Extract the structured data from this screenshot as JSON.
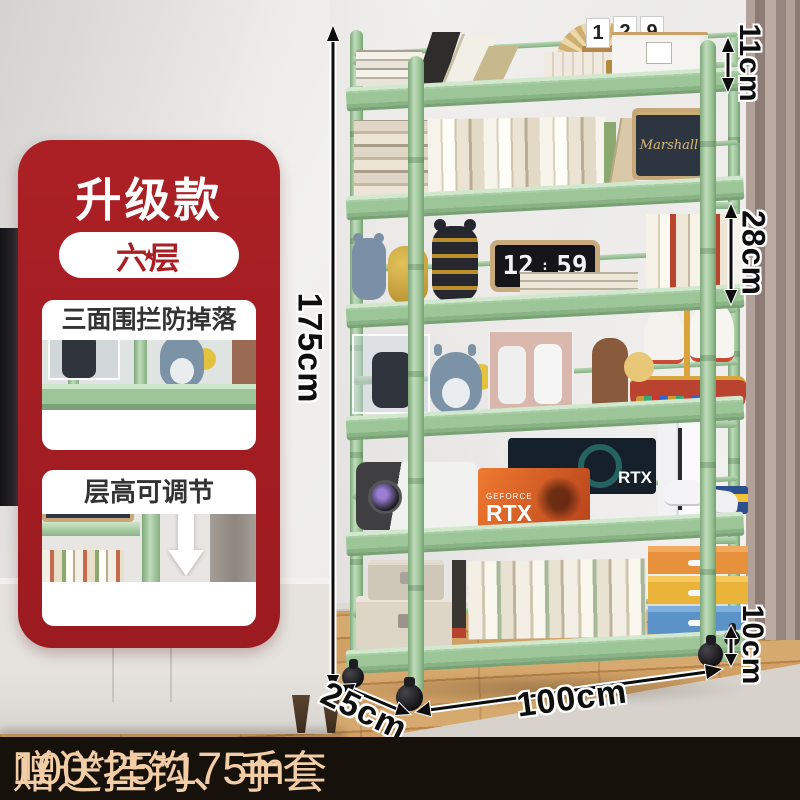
{
  "product_badge": {
    "title": "升级款",
    "tier_pill": {
      "left_star": "★",
      "label": "六层",
      "right_star": "★"
    },
    "features": [
      {
        "caption": "三面围拦防掉落"
      },
      {
        "caption": "层高可调节"
      }
    ]
  },
  "dimensions": {
    "total_height": "175cm",
    "top_guard_height": "11cm",
    "tier_spacing": "28cm",
    "wheel_clearance": "10cm",
    "width": "100cm",
    "depth": "25cm"
  },
  "shelf_decor": {
    "calendar_digits": [
      "1",
      "2",
      "9"
    ],
    "flip_clock_hour": "12",
    "flip_clock_minute": "59",
    "speaker_brand": "Marshall",
    "gpu_box_front_brand": "GEFORCE",
    "gpu_box_front_model": "RTX",
    "gpu_box_back_model": "RTX"
  },
  "footer": {
    "size_text": "100*25*175m",
    "divider": "/",
    "gift_text": "赠送挂钩、手套"
  },
  "colors": {
    "shelf_green": "#9cc598",
    "badge_red": "#a81f24",
    "footer_background": "#17110c",
    "footer_text": "#f3cda6",
    "dimension_text": "#0e0e0e",
    "curtain": "#a3918a",
    "wood_floor": "#c79a5f"
  }
}
